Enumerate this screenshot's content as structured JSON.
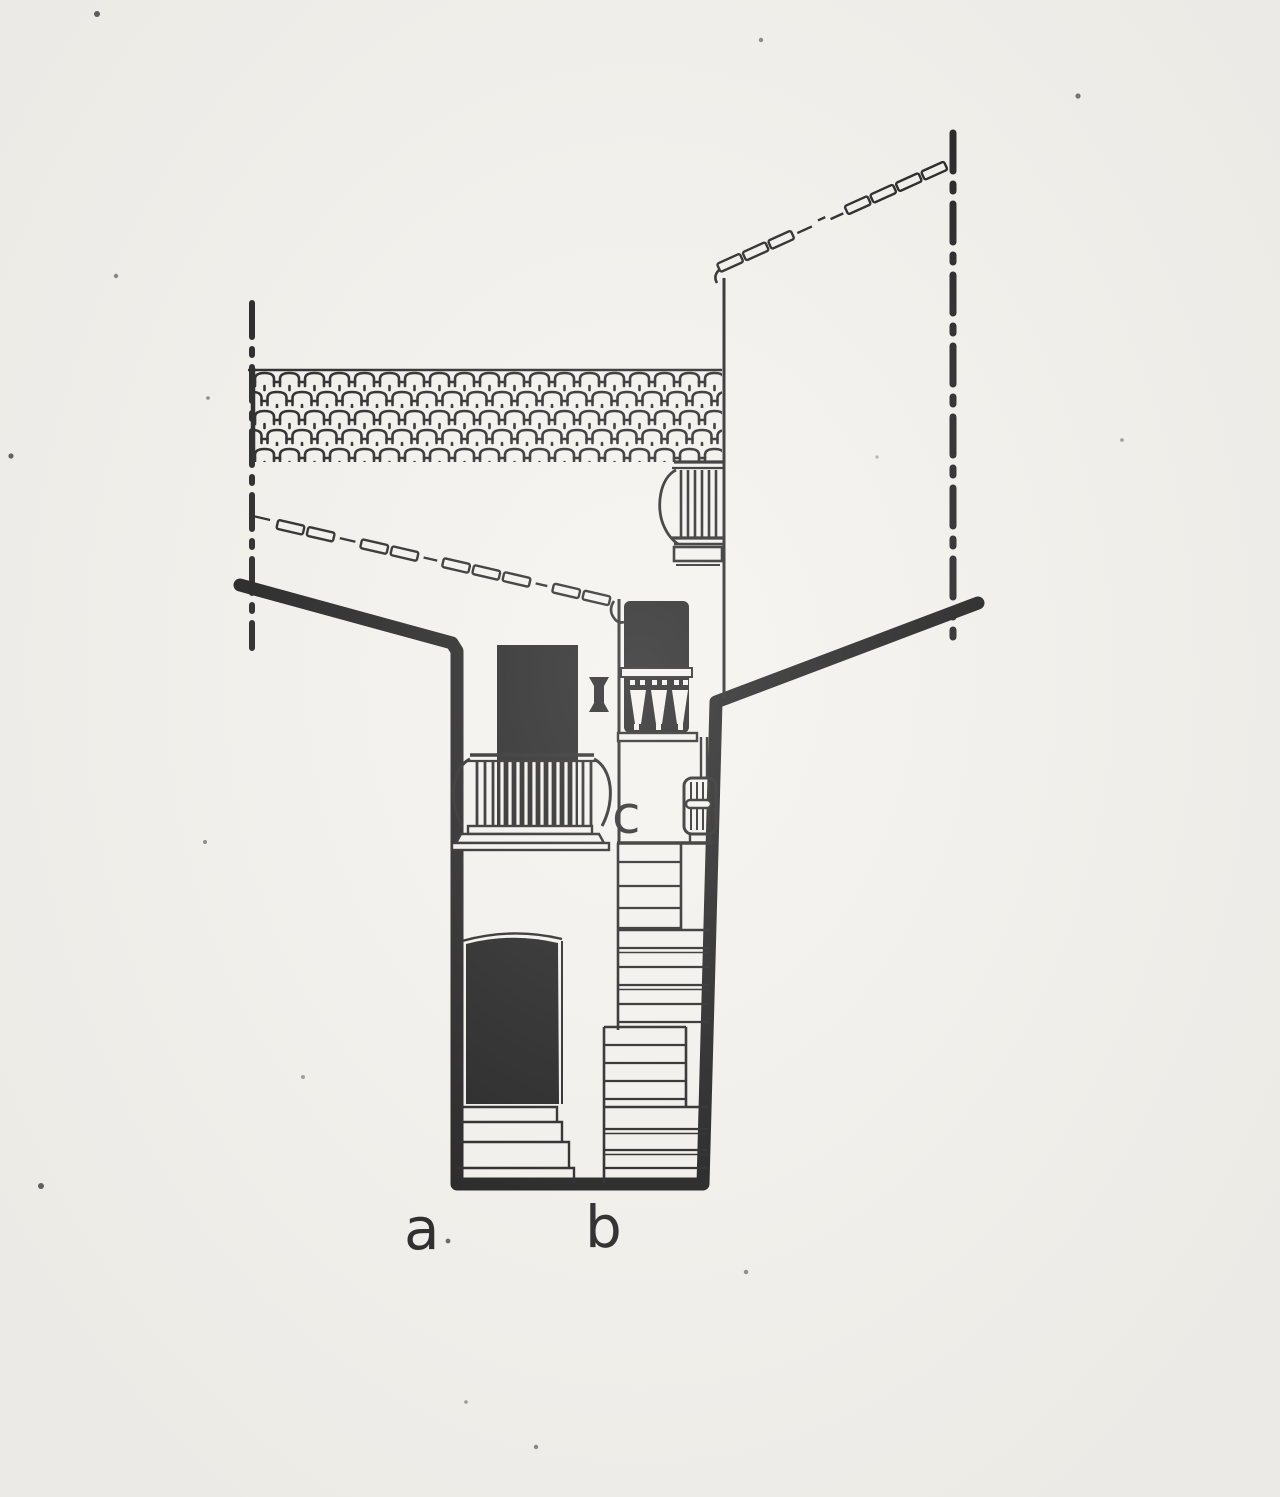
{
  "colors": {
    "paper": "#f4f2ed",
    "ink": "#1a1a1a"
  },
  "drawing": {
    "labels": {
      "a": "a",
      "b": "b",
      "c": "c"
    }
  }
}
